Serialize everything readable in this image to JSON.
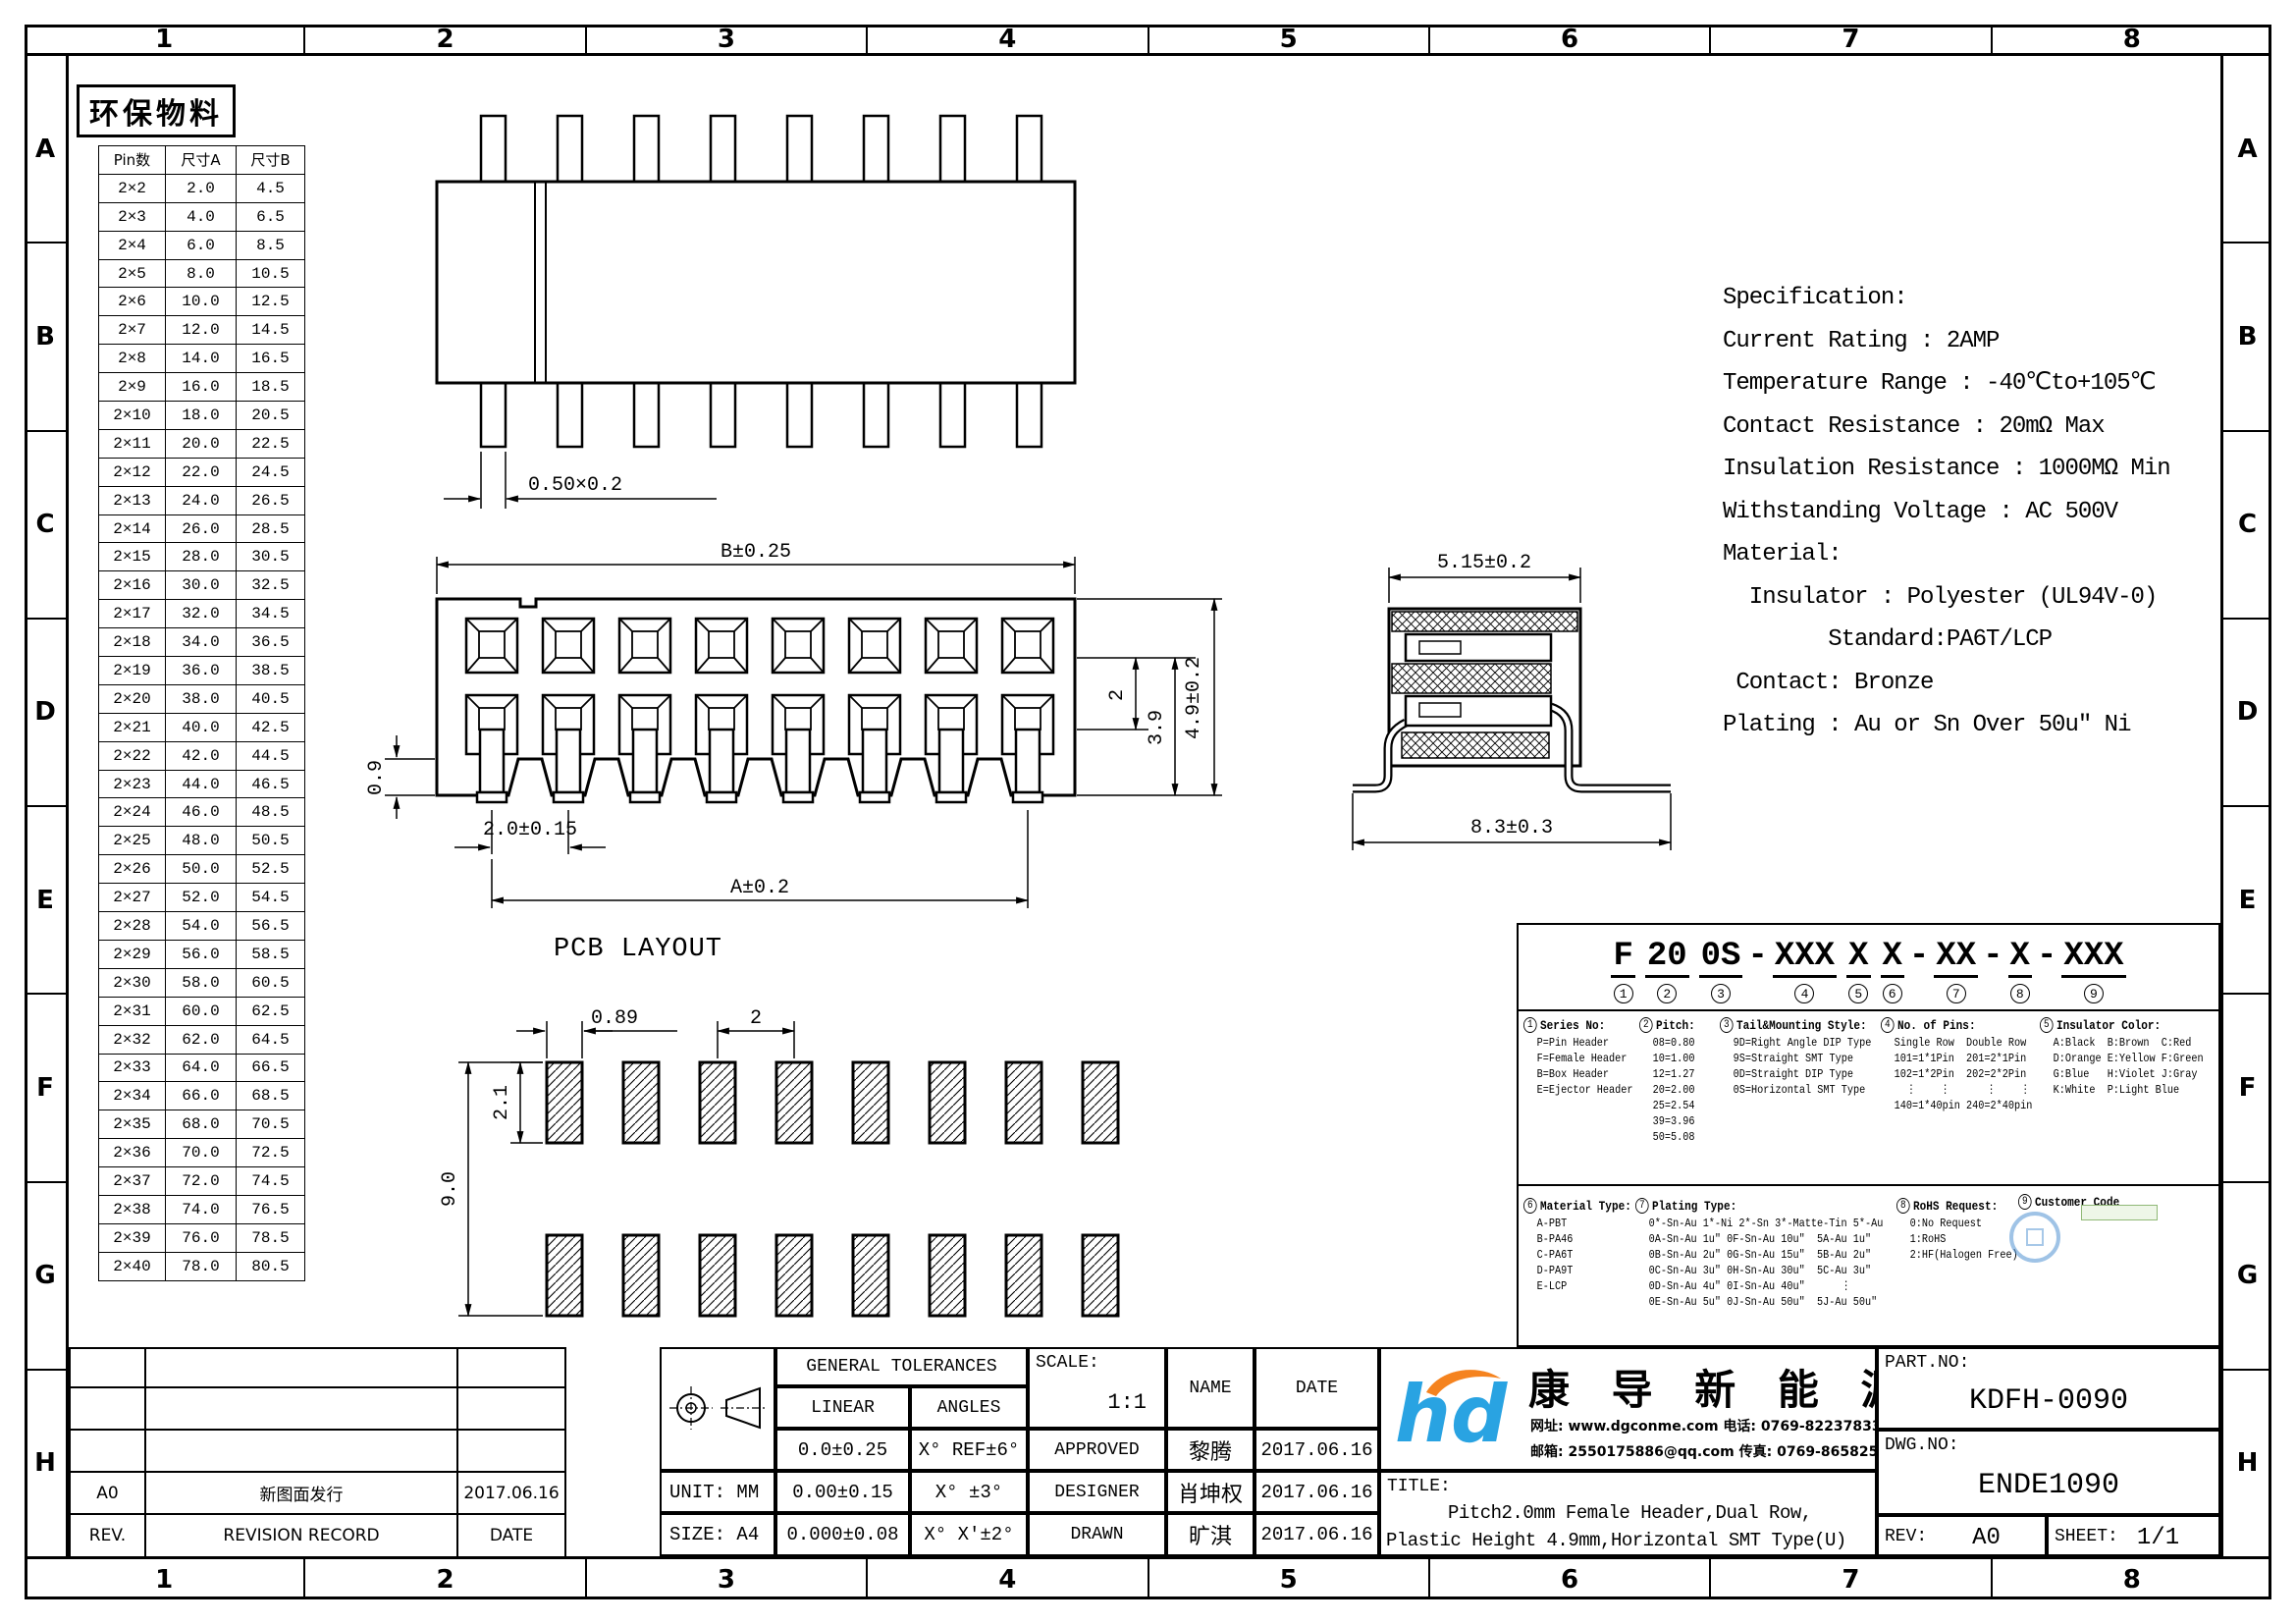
{
  "sheet": {
    "zone_columns": [
      "1",
      "2",
      "3",
      "4",
      "5",
      "6",
      "7",
      "8"
    ],
    "zone_rows": [
      "A",
      "B",
      "C",
      "D",
      "E",
      "F",
      "G",
      "H"
    ],
    "eco_label": "环保物料"
  },
  "pin_table": {
    "headers": [
      "Pin数",
      "尺寸A",
      "尺寸B"
    ],
    "rows": [
      [
        "2×2",
        "2.0",
        "4.5"
      ],
      [
        "2×3",
        "4.0",
        "6.5"
      ],
      [
        "2×4",
        "6.0",
        "8.5"
      ],
      [
        "2×5",
        "8.0",
        "10.5"
      ],
      [
        "2×6",
        "10.0",
        "12.5"
      ],
      [
        "2×7",
        "12.0",
        "14.5"
      ],
      [
        "2×8",
        "14.0",
        "16.5"
      ],
      [
        "2×9",
        "16.0",
        "18.5"
      ],
      [
        "2×10",
        "18.0",
        "20.5"
      ],
      [
        "2×11",
        "20.0",
        "22.5"
      ],
      [
        "2×12",
        "22.0",
        "24.5"
      ],
      [
        "2×13",
        "24.0",
        "26.5"
      ],
      [
        "2×14",
        "26.0",
        "28.5"
      ],
      [
        "2×15",
        "28.0",
        "30.5"
      ],
      [
        "2×16",
        "30.0",
        "32.5"
      ],
      [
        "2×17",
        "32.0",
        "34.5"
      ],
      [
        "2×18",
        "34.0",
        "36.5"
      ],
      [
        "2×19",
        "36.0",
        "38.5"
      ],
      [
        "2×20",
        "38.0",
        "40.5"
      ],
      [
        "2×21",
        "40.0",
        "42.5"
      ],
      [
        "2×22",
        "42.0",
        "44.5"
      ],
      [
        "2×23",
        "44.0",
        "46.5"
      ],
      [
        "2×24",
        "46.0",
        "48.5"
      ],
      [
        "2×25",
        "48.0",
        "50.5"
      ],
      [
        "2×26",
        "50.0",
        "52.5"
      ],
      [
        "2×27",
        "52.0",
        "54.5"
      ],
      [
        "2×28",
        "54.0",
        "56.5"
      ],
      [
        "2×29",
        "56.0",
        "58.5"
      ],
      [
        "2×30",
        "58.0",
        "60.5"
      ],
      [
        "2×31",
        "60.0",
        "62.5"
      ],
      [
        "2×32",
        "62.0",
        "64.5"
      ],
      [
        "2×33",
        "64.0",
        "66.5"
      ],
      [
        "2×34",
        "66.0",
        "68.5"
      ],
      [
        "2×35",
        "68.0",
        "70.5"
      ],
      [
        "2×36",
        "70.0",
        "72.5"
      ],
      [
        "2×37",
        "72.0",
        "74.5"
      ],
      [
        "2×38",
        "74.0",
        "76.5"
      ],
      [
        "2×39",
        "76.0",
        "78.5"
      ],
      [
        "2×40",
        "78.0",
        "80.5"
      ]
    ]
  },
  "views": {
    "top": {
      "pin_dim": "0.50×0.2"
    },
    "front": {
      "dim_width": "B±0.25",
      "dim_standoff": "0.9",
      "dim_pitch": "2.0±0.15",
      "dim_span": "A±0.2",
      "dim_row": "2",
      "dim_h1": "3.9",
      "dim_h2": "4.9±0.2"
    },
    "pcb": {
      "title": "PCB LAYOUT",
      "dim_pad_width": "0.89",
      "dim_pitch": "2",
      "dim_pad_height": "2.1",
      "dim_span": "9.0"
    },
    "side": {
      "dim_width": "5.15±0.2",
      "dim_depth": "8.3±0.3"
    }
  },
  "specification": {
    "lines": [
      "Specification:",
      "Current Rating : 2AMP",
      "Temperature Range : -40℃to+105℃",
      "Contact Resistance : 20mΩ Max",
      "Insulation Resistance : 1000MΩ Min",
      "Withstanding Voltage : AC 500V",
      "Material:",
      "  Insulator : Polyester (UL94V-0)",
      "        Standard:PA6T/LCP",
      " Contact: Bronze",
      "Plating : Au or Sn Over 50u″ Ni"
    ]
  },
  "part_code": {
    "segments": [
      {
        "t": "F",
        "n": "1"
      },
      {
        "t": "20",
        "n": "2"
      },
      {
        "t": "0S",
        "n": "3"
      },
      {
        "t": "-",
        "n": ""
      },
      {
        "t": "XXX",
        "n": "4"
      },
      {
        "t": "X",
        "n": "5"
      },
      {
        "t": "X",
        "n": "6"
      },
      {
        "t": "-",
        "n": ""
      },
      {
        "t": "XX",
        "n": "7"
      },
      {
        "t": "-",
        "n": ""
      },
      {
        "t": "X",
        "n": "8"
      },
      {
        "t": "-",
        "n": ""
      },
      {
        "t": "XXX",
        "n": "9"
      }
    ],
    "sections": [
      {
        "num": "1",
        "title": "Series No:",
        "lines": [
          "P=Pin Header",
          "F=Female Header",
          "B=Box Header",
          "E=Ejector Header"
        ]
      },
      {
        "num": "2",
        "title": "Pitch:",
        "lines": [
          "08=0.80",
          "10=1.00",
          "12=1.27",
          "20=2.00",
          "25=2.54",
          "39=3.96",
          "50=5.08"
        ]
      },
      {
        "num": "3",
        "title": "Tail&Mounting Style:",
        "lines": [
          "9D=Right Angle DIP Type",
          "9S=Straight SMT Type",
          "0D=Straight DIP Type",
          "0S=Horizontal SMT Type"
        ]
      },
      {
        "num": "4",
        "title": "No. of Pins:",
        "lines": [
          "Single Row  Double Row",
          "101=1*1Pin  201=2*1Pin",
          "102=1*2Pin  202=2*2Pin",
          "  ⋮    ⋮      ⋮    ⋮",
          "140=1*40pin 240=2*40pin"
        ]
      },
      {
        "num": "5",
        "title": "Insulator Color:",
        "lines": [
          "A:Black  B:Brown  C:Red",
          "D:Orange E:Yellow F:Green",
          "G:Blue   H:Violet J:Gray",
          "K:White  P:Light Blue"
        ]
      },
      {
        "num": "6",
        "title": "Material Type:",
        "lines": [
          "A-PBT",
          "B-PA46",
          "C-PA6T",
          "D-PA9T",
          "E-LCP"
        ]
      },
      {
        "num": "7",
        "title": "Plating Type:",
        "lines": [
          "0*-Sn-Au 1*-Ni 2*-Sn 3*-Matte-Tin 5*-Au",
          "0A-Sn-Au 1u″ 0F-Sn-Au 10u″  5A-Au 1u″",
          "0B-Sn-Au 2u″ 0G-Sn-Au 15u″  5B-Au 2u″",
          "0C-Sn-Au 3u″ 0H-Sn-Au 30u″  5C-Au 3u″",
          "0D-Sn-Au 4u″ 0I-Sn-Au 40u″      ⋮",
          "0E-Sn-Au 5u″ 0J-Sn-Au 50u″  5J-Au 50u″"
        ]
      },
      {
        "num": "8",
        "title": "RoHS Request:",
        "lines": [
          "0:No Request",
          "1:RoHS",
          "2:HF(Halogen Free)"
        ]
      },
      {
        "num": "9",
        "title": "Customer Code",
        "lines": []
      }
    ]
  },
  "title_block": {
    "revision": {
      "rows": [
        [
          "",
          "",
          ""
        ],
        [
          "",
          "",
          ""
        ],
        [
          "",
          "",
          ""
        ],
        [
          "A0",
          "新图面发行",
          "2017.06.16"
        ],
        [
          "REV.",
          "REVISION RECORD",
          "DATE"
        ]
      ]
    },
    "unit_label": "UNIT: MM",
    "size_label": "SIZE: A4",
    "tolerances": {
      "header": "GENERAL TOLERANCES",
      "linear": "LINEAR",
      "angles": "ANGLES",
      "rows": [
        [
          "0.0±0.25",
          "X° REF±6°"
        ],
        [
          "0.00±0.15",
          "X° ±3°"
        ],
        [
          "0.000±0.08",
          "X° X'±2°"
        ]
      ]
    },
    "approval": {
      "scale_label": "SCALE:",
      "scale_value": "1:1",
      "name_header": "NAME",
      "date_header": "DATE",
      "rows": [
        {
          "role": "APPROVED",
          "name": "黎腾",
          "date": "2017.06.16"
        },
        {
          "role": "DESIGNER",
          "name": "肖坤权",
          "date": "2017.06.16"
        },
        {
          "role": "DRAWN",
          "name": "旷淇",
          "date": "2017.06.16"
        }
      ]
    },
    "company": {
      "name": "康 导 新 能 源",
      "contact1": "网址: www.dgconme.com   电话: 0769-82237833",
      "contact2": "邮箱: 2550175886@qq.com  传真: 0769-86582527"
    },
    "title": {
      "label": "TITLE:",
      "line1": "Pitch2.0mm Female Header,Dual Row,",
      "line2": "Plastic Height 4.9mm,Horizontal SMT Type(U)"
    },
    "part_no": {
      "label": "PART.NO:",
      "value": "KDFH-0090"
    },
    "dwg_no": {
      "label": "DWG.NO:",
      "value": "ENDE1090"
    },
    "rev": {
      "label": "REV:",
      "value": "A0"
    },
    "sheet_no": {
      "label": "SHEET:",
      "value": "1/1"
    }
  },
  "colors": {
    "line": "#000000",
    "logo_blue": "#29A3E2",
    "logo_orange": "#F5831F"
  }
}
